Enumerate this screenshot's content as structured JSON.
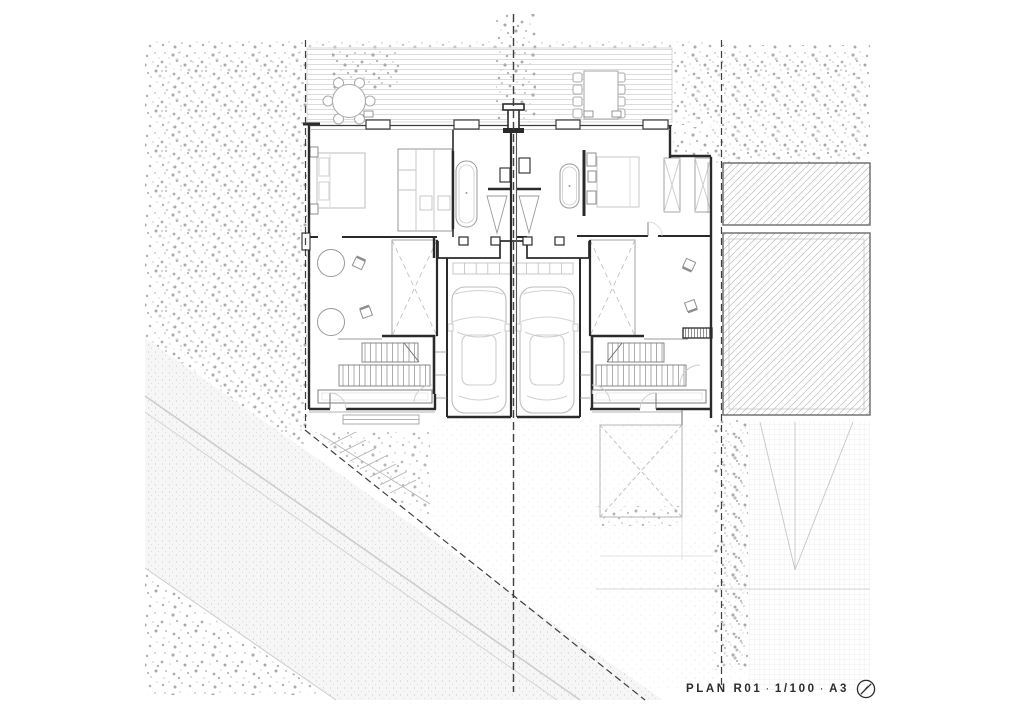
{
  "title_block": {
    "plan_name": "PLAN R01",
    "separator": "·",
    "scale": "1/100",
    "paper": "A3"
  },
  "icons": {
    "north_arrow": "north-arrow-icon"
  },
  "colors": {
    "paper": "#ffffff",
    "wall": "#2a2a2a",
    "furniture_line": "#b5b5b5",
    "vegetation_dot": "#b0b0b0",
    "property_line": "#3d3d3d",
    "hatch": "#c4c4c4"
  }
}
